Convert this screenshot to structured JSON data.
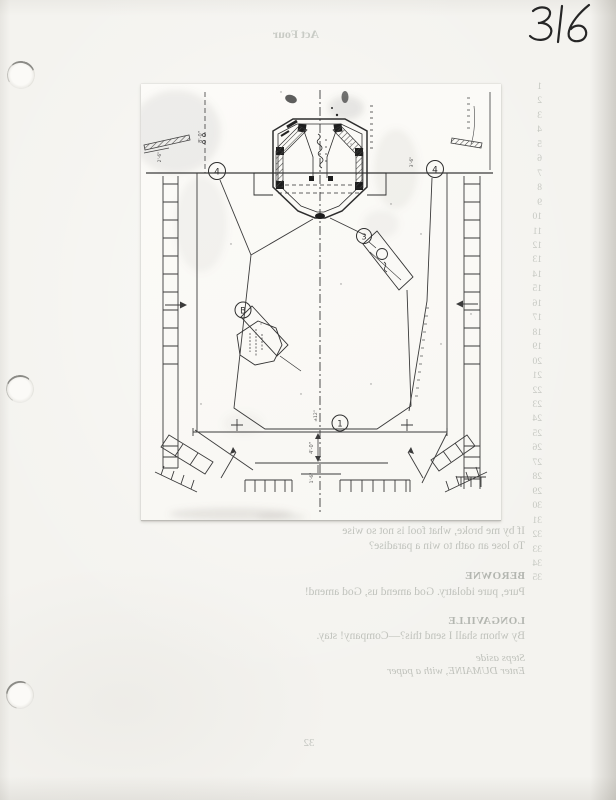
{
  "page": {
    "handwritten_folio": "316"
  },
  "plan": {
    "bubbles": {
      "grid_left": "4",
      "grid_right": "4",
      "unit_ramp": "3",
      "unit_prop": "B",
      "front": "1"
    },
    "dims": {
      "d8": "8'-0\"",
      "d26": "2'-6\"",
      "d36": "3'-6\"",
      "d12": "±12\"",
      "d40": "4'-0\"",
      "d16": "1'-6\""
    }
  },
  "showthrough": {
    "act_header": "Act Four",
    "line_numbers": [
      "1",
      "2",
      "3",
      "4",
      "5",
      "6",
      "7",
      "8",
      "9",
      "10",
      "11",
      "12",
      "13",
      "14",
      "15",
      "16",
      "17",
      "18",
      "19",
      "20",
      "21",
      "22",
      "23",
      "24",
      "25",
      "26",
      "27",
      "28",
      "29",
      "30",
      "31",
      "32",
      "33",
      "34",
      "35"
    ],
    "script": {
      "sonnet_line1": "If by me broke, what fool is not so wise",
      "sonnet_line2": "To lose an oath to win a paradise?",
      "speaker1": "BEROWNE",
      "speech1": "Pure, pure idolatry. God amend us, God amend!",
      "speaker2": "LONGAVILLE",
      "speech2": "By whom shall I send this?—Company! stay.",
      "stage_direction1": "Steps aside",
      "stage_direction2": "Enter DUMAINE, with a paper"
    },
    "book_page_number": "32"
  }
}
